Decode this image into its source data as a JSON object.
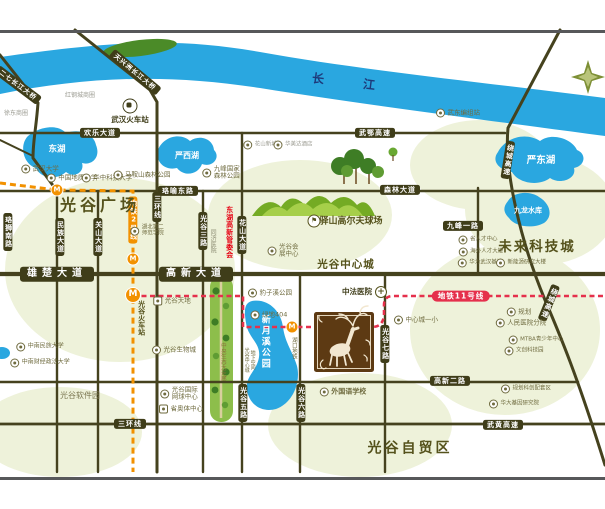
{
  "water": {
    "yangtze_1": "长",
    "yangtze_2": "江",
    "east_lake": "东湖",
    "yanxi_lake": "严西湖",
    "yandong_lake": "严东湖",
    "jiulong_reservoir": "九龙水库",
    "xinyuexi_park": "新月溪公园"
  },
  "bridges": {
    "erqi": "二七长江大桥",
    "tianxingzhou": "天兴洲长江大桥"
  },
  "roads": {
    "huanle": "欢乐大道",
    "wue_expwy": "武鄂高速",
    "luoyu_east": "珞喻东路",
    "senlin": "森林大道",
    "jiufeng_1st": "九峰一路",
    "xiongchu": "雄楚大道",
    "gaoxin": "高新大道",
    "gaoxin_2nd": "高新二路",
    "sanhuan_h": "三环线",
    "sanhuan_v": "三环线",
    "wuhuang_expwy": "武黄高速",
    "luoshi_south": "珞狮南路",
    "minzu": "民族大道",
    "guanshan": "关山大道",
    "guanggu_3rd": "光谷三路",
    "huashan": "花山大道",
    "guanggu_5th": "光谷五路",
    "guanggu_6th": "光谷六路",
    "guanggu_7th": "光谷七路",
    "raocheng_1": "绕城高速",
    "raocheng_2": "绕城高速"
  },
  "metro": {
    "line2_label": "地铁2号线",
    "line11_label": "地铁11号线",
    "m_badge": "M"
  },
  "districts": {
    "guanggu_square": "光谷广场",
    "future_city": "未来科技城",
    "center_city": "光谷中心城",
    "ftz": "光谷自贸区",
    "software_park": "光谷软件园",
    "eco_corridor": "中央生态大走廊",
    "golf": "驿山高尔夫球场",
    "gov": "东湖高新管委会",
    "station_name": "光谷火车站"
  },
  "pois": {
    "station": "武汉火车站",
    "honggang": "红钢城商圈",
    "xudong": "徐东商圈",
    "wudong": "武东编组站",
    "wuhan_univ": "武汉大学",
    "geo_univ": "中国地质大学",
    "hust": "华中科技大学",
    "maanshan": "马鞍山森林公园",
    "jiufeng_park_1": "九峰国家",
    "jiufeng_park_2": "森林公园",
    "hubei_2nd_1": "湖北第二",
    "hubei_2nd_2": "师范学院",
    "tongji": "同济医院",
    "expo_1": "光谷会",
    "expo_2": "展中心",
    "huashan_town": "花山新城",
    "hotel": "华美达酒店",
    "tiandi": "光谷天地",
    "biocity": "光谷生物城",
    "tennis_1": "光谷国际",
    "tennis_2": "网球中心",
    "aoti": "省奥体中心",
    "lvdi404": "绿地404",
    "baozixi": "豹子溪公园",
    "underground_1": "光谷中心城",
    "underground_2": "地下空间",
    "hukou": "湖口地铁",
    "zhongfa": "中法医院",
    "yixiao": "中心城一小",
    "foreign_school": "外国语学校",
    "guihua": "规划",
    "renmin": "人民医院分院",
    "mtba": "MTBA青少年中心",
    "wenchuang": "文创科技园",
    "guihua_area": "规划科创配套区",
    "huada": "华大基因研究院",
    "rencai": "省人才中心",
    "haiwai": "海外人才大楼",
    "huawei": "华为武汉基地",
    "xinnengyuan": "新能源研究大楼",
    "minzu_univ": "中南民族大学",
    "caijing_univ": "中南财经政法大学"
  },
  "colors": {
    "road": "#45421e",
    "water": "#2aa7e0",
    "metro2": "#f29100",
    "metro11": "#e5304c",
    "accent_red": "#e60012",
    "olive": "#55521c",
    "logo_brown": "#5d3a13"
  }
}
